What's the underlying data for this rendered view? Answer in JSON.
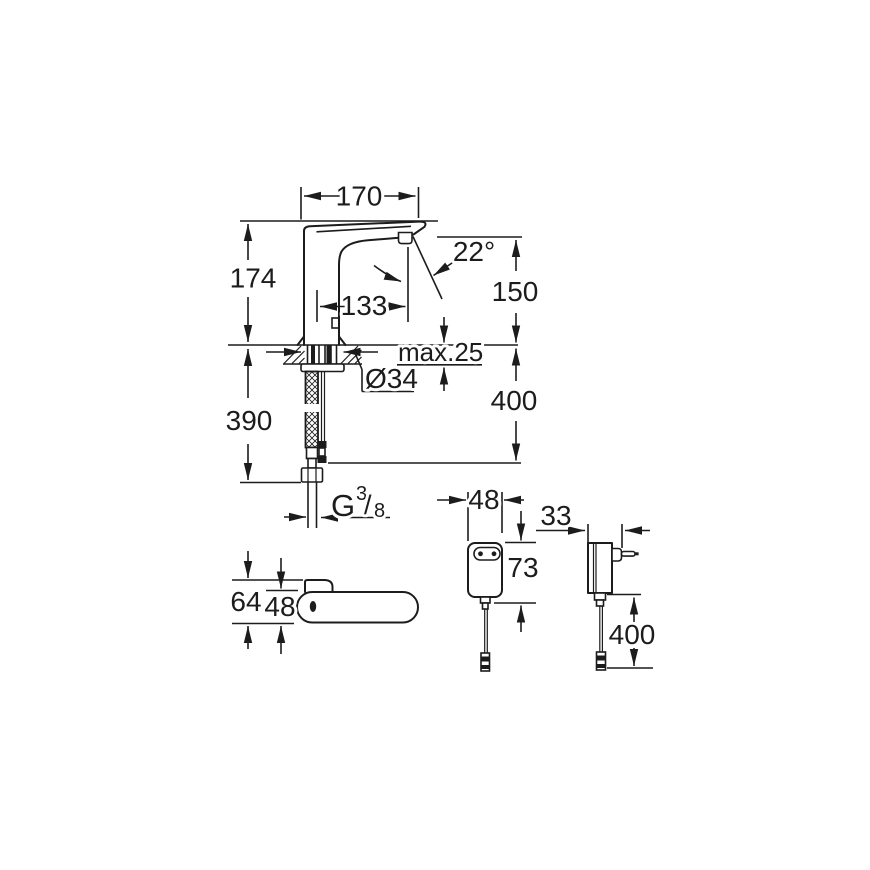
{
  "drawing": {
    "type": "technical-dimension-drawing",
    "subject": "sensor faucet with power adapter",
    "colors": {
      "line": "#1c1c1c",
      "background": "#ffffff"
    },
    "main_view": {
      "spout_projection": "170",
      "height_to_spout_top": "174",
      "spout_angle": "22°",
      "spout_outlet_height": "150",
      "spout_reach": "133",
      "max_deck_thickness": "max.25",
      "hole_diameter": "Ø34",
      "cable_length_below_deck": "400",
      "hose_length": "390",
      "thread": {
        "prefix": "G",
        "numerator": "3",
        "slash": "/",
        "denominator": "8"
      }
    },
    "top_view": {
      "overall_depth": "64",
      "body_depth": "48"
    },
    "adapter_front_view": {
      "width": "48",
      "height": "73"
    },
    "adapter_side_view": {
      "depth": "33",
      "cable_length": "400"
    }
  }
}
